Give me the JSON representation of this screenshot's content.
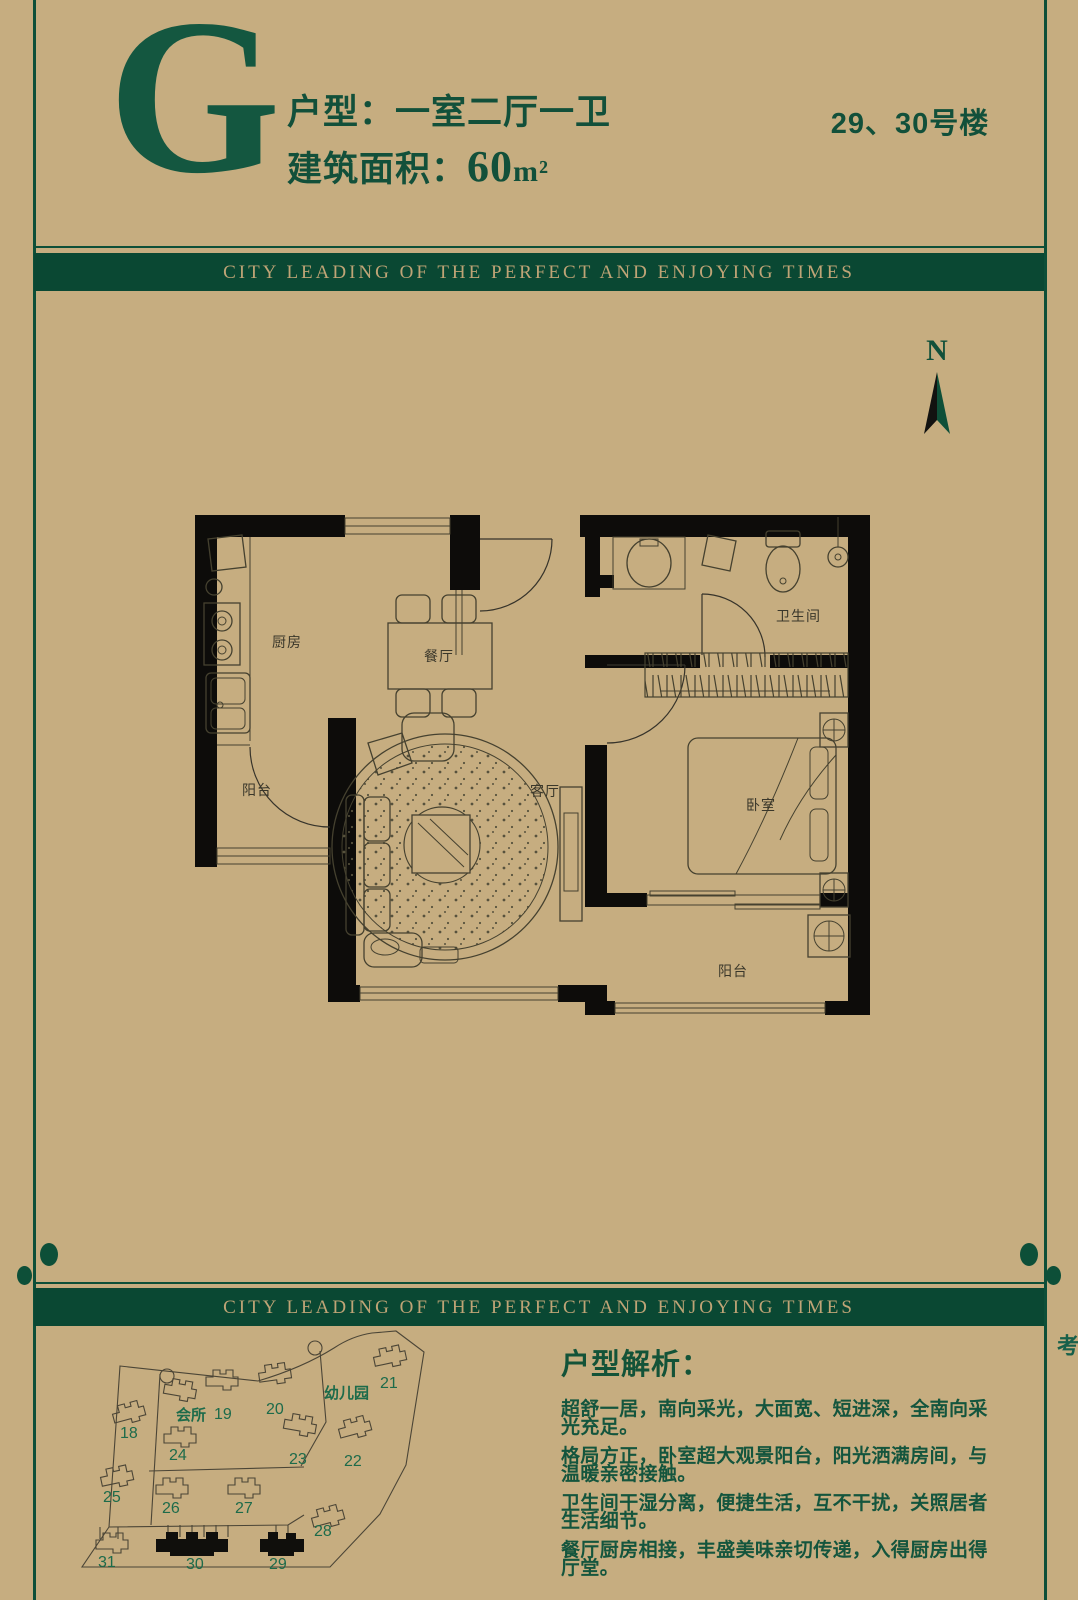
{
  "colors": {
    "background": "#c6ad80",
    "green": "#0d4f38",
    "gold": "#bfa476",
    "wall_black": "#0d0c0a"
  },
  "header": {
    "unit_letter": "G",
    "unit_type": "户型：一室二厅一卫",
    "area_prefix": "建筑面积：",
    "area_value": "60",
    "area_unit": "m²",
    "building_no": "29、30号楼"
  },
  "banner": {
    "text": "CITY LEADING OF THE PERFECT AND ENJOYING TIMES"
  },
  "compass": {
    "label": "N"
  },
  "floorplan": {
    "room_labels": {
      "kitchen": "厨房",
      "dining": "餐厅",
      "living": "客厅",
      "bathroom": "卫生间",
      "bedroom": "卧室",
      "balcony_left": "阳台",
      "balcony_bottom": "阳台"
    }
  },
  "sitemap": {
    "clubhouse_label": "会所",
    "kindergarten_label": "幼儿园",
    "buildings": [
      {
        "label": "18"
      },
      {
        "label": "19"
      },
      {
        "label": "20"
      },
      {
        "label": "21"
      },
      {
        "label": "22"
      },
      {
        "label": "23"
      },
      {
        "label": "24"
      },
      {
        "label": "25"
      },
      {
        "label": "26"
      },
      {
        "label": "27"
      },
      {
        "label": "28"
      },
      {
        "label": "29"
      },
      {
        "label": "30"
      },
      {
        "label": "31"
      }
    ],
    "highlighted_buildings": "29、30"
  },
  "analysis": {
    "title": "户型解析：",
    "lines": [
      "超舒一居，南向采光，大面宽、短进深，全南向采光充足。",
      "格局方正，卧室超大观景阳台，阳光洒满房间，与温暖亲密接触。",
      "卫生间干湿分离，便捷生活，互不干扰，关照居者生活细节。",
      "餐厅厨房相接，丰盛美味亲切传递，入得厨房出得厅堂。"
    ]
  },
  "side_note": {
    "text": "此户型只做参考"
  }
}
